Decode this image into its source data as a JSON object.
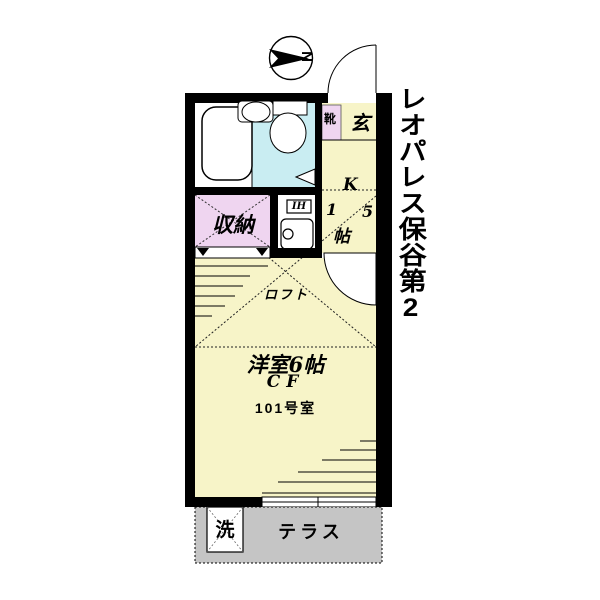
{
  "title": {
    "text": "レオパレス保谷第2"
  },
  "compass": {
    "label": "N"
  },
  "rooms": {
    "entrance": {
      "label": "玄",
      "shoebox_label": "靴"
    },
    "kitchen": {
      "full_label": "K 1.5帖",
      "label_chars": [
        "K",
        "1",
        "5",
        "帖"
      ],
      "ih_label": "IH"
    },
    "closet": {
      "label": "収納"
    },
    "loft": {
      "label": "ロフト"
    },
    "main_room": {
      "label": "洋室6帖",
      "floor_type": "CF",
      "unit_number": "101号室"
    },
    "terrace": {
      "label": "テラス",
      "laundry_label": "洗"
    }
  },
  "colors": {
    "wall": "#000000",
    "room_yellow": "#f7f4c8",
    "closet_pink": "#efd5f0",
    "bath_cyan": "#c9edf2",
    "terrace_gray": "#c5c5c5",
    "background": "#ffffff"
  }
}
